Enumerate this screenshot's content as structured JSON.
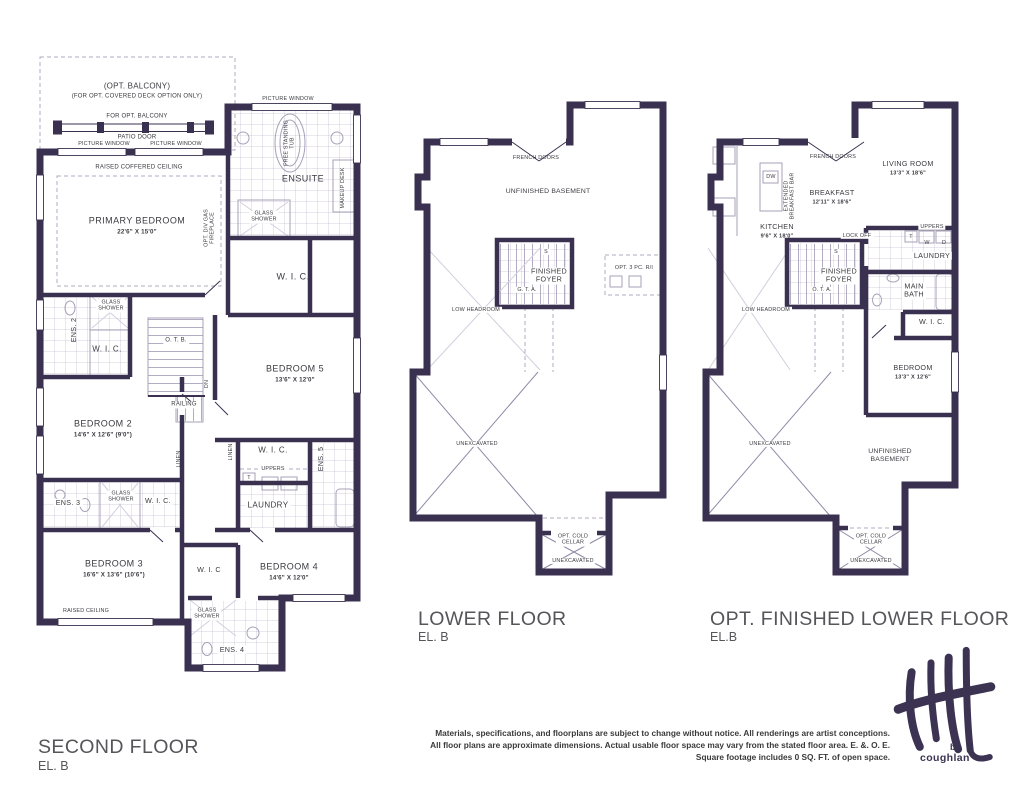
{
  "plans": {
    "second": {
      "title": "SECOND FLOOR",
      "el": "EL. B",
      "balcony1": "(OPT. BALCONY)",
      "balcony2": "(FOR OPT. COVERED DECK OPTION ONLY)",
      "for_opt_balcony": "FOR OPT. BALCONY",
      "patio_door": "PATIO DOOR",
      "picture_window": "PICTURE WINDOW",
      "raised_coffered": "RAISED COFFERED CEILING",
      "primary": "PRIMARY BEDROOM",
      "primary_dim": "22'6\" X 15'0\"",
      "fireplace": "OPT. D/V GAS\nFIREPLACE",
      "tub": "FREE STANDING\nTUB",
      "ensuite": "ENSUITE",
      "makeup": "MAKEUP DESK",
      "glass_shower": "GLASS\nSHOWER",
      "wic": "W. I. C.",
      "wic_s": "W. I. C",
      "ens2": "ENS. 2",
      "otb": "O. T. B.",
      "dn": "DN",
      "railing": "RAILING",
      "bedroom5": "BEDROOM 5",
      "bedroom5_dim": "13'6\" X 12'0\"",
      "bedroom2": "BEDROOM 2",
      "bedroom2_dim": "14'6\" X 12'6\" (9'0\")",
      "linen": "LINEN",
      "ens5": "ENS. 5",
      "uppers": "UPPERS",
      "t": "T",
      "w": "W",
      "d": "D",
      "laundry": "LAUNDRY",
      "ens3": "ENS. 3",
      "bedroom3": "BEDROOM 3",
      "bedroom3_dim": "16'6\" X 13'6\" (10'6\")",
      "bedroom4": "BEDROOM 4",
      "bedroom4_dim": "14'6\" X 12'0\"",
      "raised_ceiling": "RAISED CEILING",
      "ens4": "ENS. 4"
    },
    "lower": {
      "title": "LOWER FLOOR",
      "el": "EL. B",
      "french_doors": "FRENCH DOORS",
      "unfinished": "UNFINISHED BASEMENT",
      "foyer": "FINISHED\nFOYER",
      "gta": "G. T. A.",
      "s": "S",
      "low_headroom": "LOW HEADROOM",
      "opt_3pc": "OPT. 3 PC. R/I",
      "unexcavated": "UNEXCAVATED",
      "cold_cellar": "OPT. COLD\nCELLAR",
      "unexcavated2": "UNEXCAVATED"
    },
    "opt": {
      "title": "OPT. FINISHED LOWER FLOOR",
      "el": "EL.B",
      "french_doors": "FRENCH DOORS",
      "living": "LIVING ROOM",
      "living_dim": "13'3\" X 18'6\"",
      "dw": "DW",
      "ext_bar": "EXTENDED\nBREAKFAST BAR",
      "breakfast": "BREAKFAST",
      "breakfast_dim": "12'11\" X 18'6\"",
      "kitchen": "KITCHEN",
      "kitchen_dim": "9'6\" X 18'0\"",
      "lock_off": "LOCK OFF",
      "s": "S",
      "foyer": "FINISHED\nFOYER",
      "ota": "O. T. A.",
      "uppers": "UPPERS",
      "t": "T",
      "w": "W",
      "d": "D",
      "laundry": "LAUNDRY",
      "main_bath": "MAIN\nBATH",
      "wic": "W. I. C.",
      "low_headroom": "LOW HEADROOM",
      "bedroom": "BEDROOM",
      "bedroom_dim": "13'3\" X 12'6\"",
      "unfinished": "UNFINISHED\nBASEMENT",
      "unexcavated": "UNEXCAVATED",
      "cold_cellar": "OPT. COLD\nCELLAR",
      "unexcavated2": "UNEXCAVATED"
    }
  },
  "disclaimer": {
    "l1": "Materials, specifications, and floorplans are subject to change without notice. All renderings are artist conceptions.",
    "l2": "All floor plans are approximate dimensions. Actual usable floor space may vary from the stated floor area. E. &. O. E.",
    "l3": "Square footage includes 0 SQ. FT. of open space."
  },
  "logo": {
    "by": "by",
    "name": "coughlan"
  },
  "colors": {
    "wall": "#3a3150",
    "line": "#a7a1b8",
    "text": "#3b3a40"
  }
}
